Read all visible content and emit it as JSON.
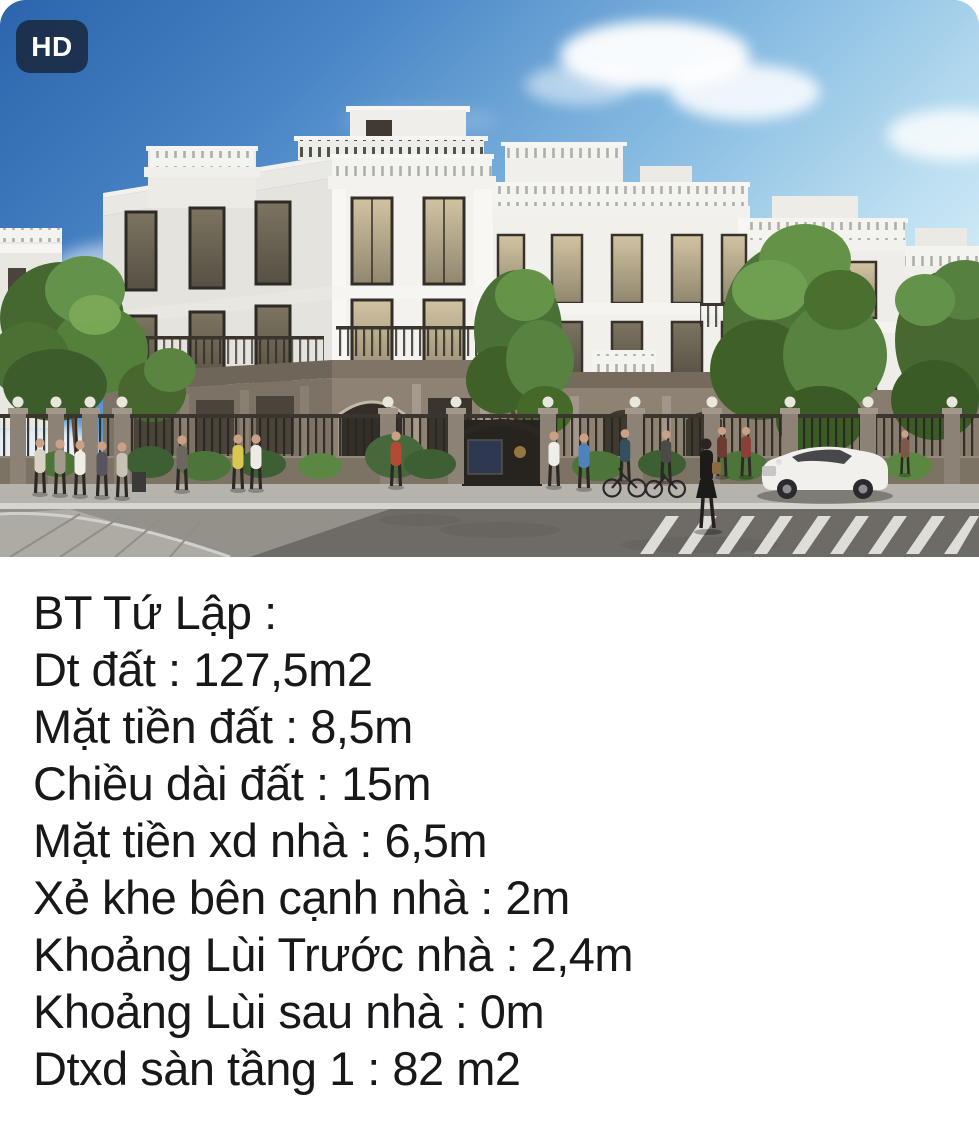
{
  "badge": {
    "label": "HD"
  },
  "photo": {
    "description": "3D render of a row of white neoclassical villas behind an iron fence with lamp pillars, trees, pedestrians, two cyclists, a woman crossing a zebra crosswalk and a white coupe on the street under a blue sky",
    "colors": {
      "sky_deep_blue": "#2b64ab",
      "sky_pale_cyan": "#cdeaf7",
      "facade_white": "#f3f2ee",
      "ground_floor_taupe": "#8e8273",
      "foliage_green": "#4d7338",
      "road_gray": "#94918b",
      "badge_bg": "#162133"
    }
  },
  "caption": {
    "lines": [
      "BT Tứ Lập :",
      "Dt đất : 127,5m2",
      "Mặt tiền đất : 8,5m",
      "Chiều dài đất : 15m",
      "Mặt tiền xd nhà : 6,5m",
      "Xẻ khe bên cạnh nhà : 2m",
      "Khoảng Lùi Trước nhà : 2,4m",
      "Khoảng Lùi sau nhà : 0m",
      "Dtxd sàn tầng 1 : 82 m2"
    ]
  }
}
